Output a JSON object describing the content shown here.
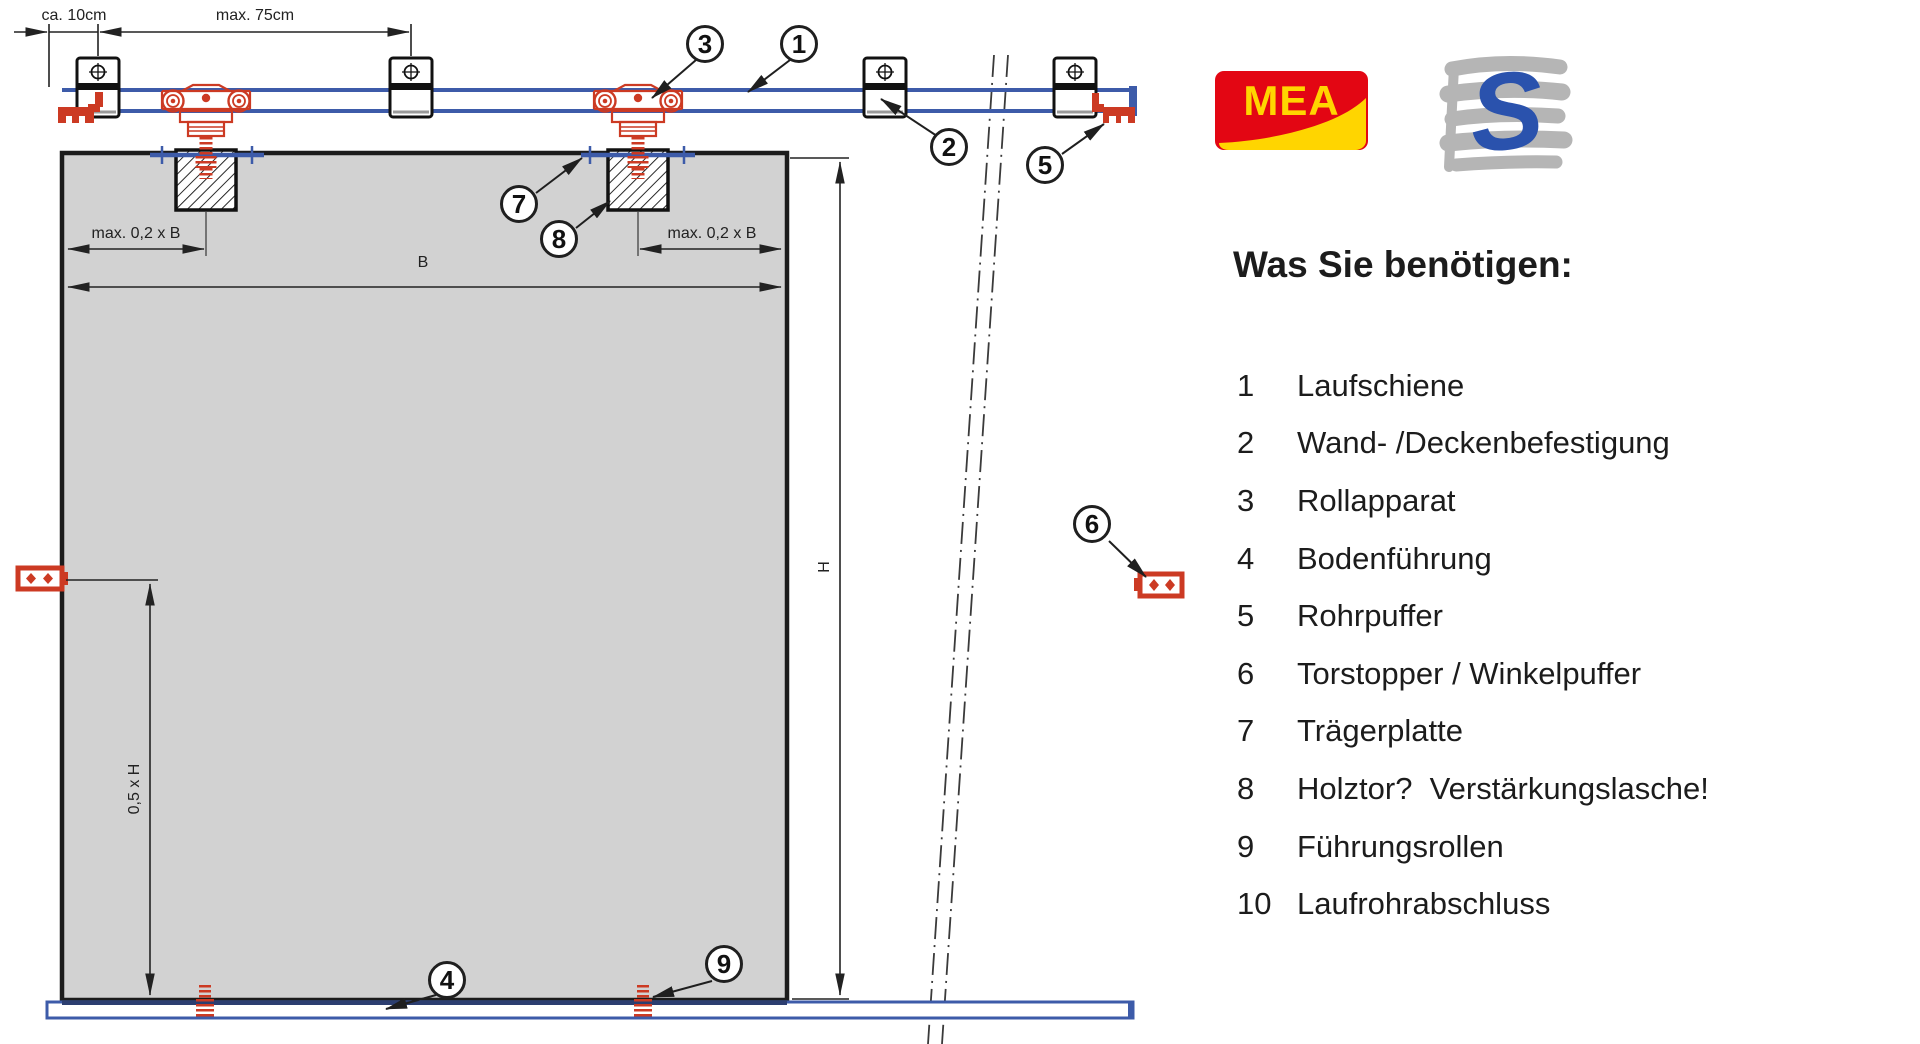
{
  "diagram": {
    "dimensions": {
      "ca10": "ca. 10cm",
      "max75": "max. 75cm",
      "maxb_left": "max. 0,2 x B",
      "maxb_right": "max. 0,2 x B",
      "b": "B",
      "h": "H",
      "half_h": "0,5 x H"
    },
    "callouts": [
      {
        "number": "1"
      },
      {
        "number": "2"
      },
      {
        "number": "3"
      },
      {
        "number": "4"
      },
      {
        "number": "5"
      },
      {
        "number": "6"
      },
      {
        "number": "7"
      },
      {
        "number": "8"
      },
      {
        "number": "9"
      }
    ],
    "colors": {
      "rail_blue": "#3d5ba9",
      "part_red": "#cc3a23",
      "door_gray": "#d2d2d2",
      "line_dark": "#1c1c1c"
    }
  },
  "logos": {
    "mea": "MEA",
    "s": "S"
  },
  "parts": {
    "title": "Was Sie benötigen:",
    "items": [
      {
        "num": "1",
        "label": "Laufschiene"
      },
      {
        "num": "2",
        "label": "Wand- /Deckenbefestigung"
      },
      {
        "num": "3",
        "label": "Rollapparat"
      },
      {
        "num": "4",
        "label": "Bodenführung"
      },
      {
        "num": "5",
        "label": "Rohrpuffer"
      },
      {
        "num": "6",
        "label": "Torstopper / Winkelpuffer"
      },
      {
        "num": "7",
        "label": "Trägerplatte"
      },
      {
        "num": "8",
        "label": "Holztor?  Verstärkungslasche!"
      },
      {
        "num": "9",
        "label": "Führungsrollen"
      },
      {
        "num": "10",
        "label": "Laufrohrabschluss"
      }
    ]
  }
}
